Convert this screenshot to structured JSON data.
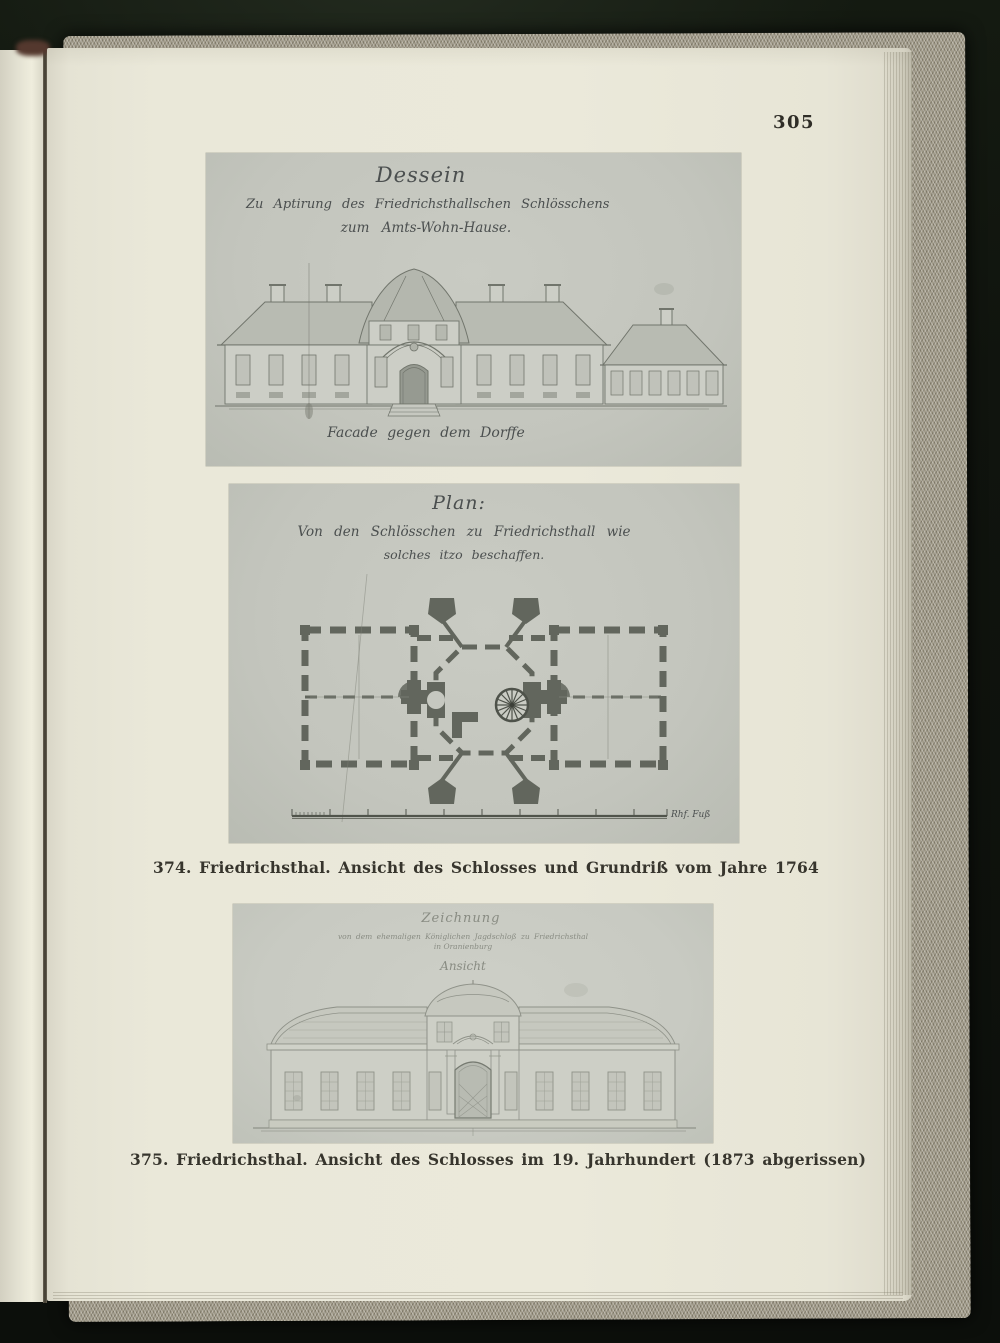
{
  "page": {
    "number": "305"
  },
  "plate_1764_elevation": {
    "title": "Dessein",
    "subtitle_line1": "Zu Aptirung des Friedrichsthallschen Schlösschens",
    "subtitle_line2": "zum Amts-Wohn-Hause.",
    "drawing_caption": "Facade gegen dem Dorffe"
  },
  "plate_1764_plan": {
    "title": "Plan:",
    "subtitle_line1": "Von den Schlösschen zu Friedrichsthall wie",
    "subtitle_line2": "solches itzo beschaffen.",
    "scale_label": "Rhf. Fuß"
  },
  "figure_374": {
    "caption": "374. Friedrichsthal. Ansicht des Schlosses und Grundriß vom Jahre 1764"
  },
  "plate_19c_elevation": {
    "title": "Zeichnung",
    "subtitle_line1": "von dem ehemaligen Königlichen Jagdschloß zu Friedrichsthal",
    "subtitle_line2": "in Oranienburg",
    "view_label": "Ansicht"
  },
  "figure_375": {
    "caption": "375. Friedrichsthal. Ansicht des Schlosses im 19. Jahrhundert (1873 abgerissen)"
  },
  "colors": {
    "paper": "#eae8d9",
    "plate_gray": "#c4c6be",
    "cover_cloth": "#a29c8b",
    "background": "#0d100c",
    "caption_ink": "#37352d"
  }
}
